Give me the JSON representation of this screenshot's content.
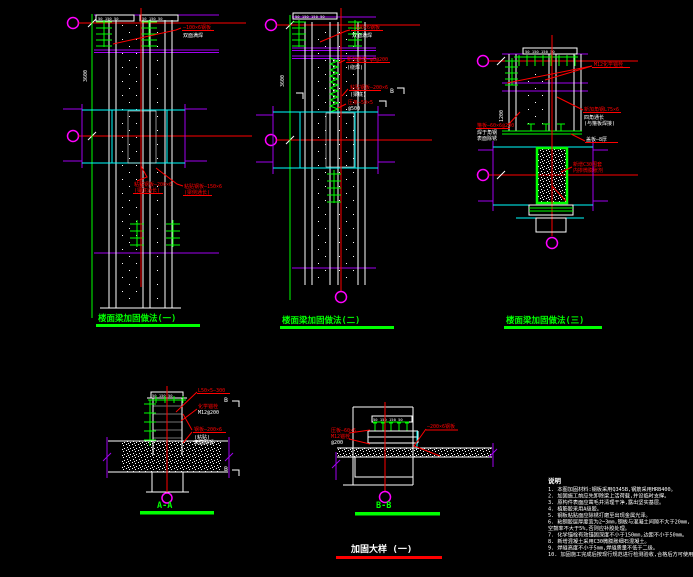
{
  "sheet": {
    "title": "加固大样 (一)"
  },
  "titles": {
    "d1": "楼面梁加固做法(一)",
    "d2": "楼面梁加固做法(二)",
    "d3": "楼面梁加固做法(三)",
    "sectionA": "A-A",
    "sectionB": "B-B"
  },
  "dims": {
    "d1_top": "50 150 50",
    "d2_top": "50 150 150 50",
    "d3_top": "50 150 150 50",
    "a_top": "50 150 50",
    "b_top": "50 150 150 50",
    "d1_h": "3600",
    "d2_h": "3600",
    "d3_h": "1200"
  },
  "callouts": {
    "d1": {
      "top1": "—100×6钢板",
      "top2": "双面满焊",
      "mid_left1": "粘贴钢板—200×6",
      "mid_left2": "(梁底通长)",
      "mid_right1": "粘贴钢板—150×6",
      "mid_right2": "(梁侧通长)"
    },
    "d2": {
      "top1": "—100×6钢板",
      "top2": "双面满焊",
      "coil1": "新加箍筋—φ8@200",
      "coil2": "(绕焊)",
      "mid1": "粘贴钢板—200×6",
      "mid2": "(梁底)",
      "low1": "压条—50×5",
      "low2": "@500",
      "section_letter": "B"
    },
    "d3": {
      "top1": "M12化学锚栓",
      "right1": "新加角钢L75×6",
      "right2": "四角通长",
      "right3": "(与箍板焊接)",
      "left1": "箍板—60×6@200",
      "left2": "焊于角钢",
      "left3": "表面除锈",
      "plate": "盖板—8厚",
      "jacket1": "新增C30围套",
      "jacket2": "内掺微膨胀剂"
    },
    "a": {
      "c1": "L50×5—300",
      "c2a": "化学锚栓",
      "c2b": "M12@200",
      "c3a": "钢板—200×6",
      "c3b": "(粘贴)",
      "c3c": "表面除锈",
      "b_letter": "B"
    },
    "b": {
      "left1": "压板—60×6",
      "left2": "M12锚栓",
      "left3": "@200",
      "right1": "—200×6钢板"
    }
  },
  "notes": {
    "header": "说明",
    "items": [
      "1. 本图加固材料:钢板采用Q345B,钢筋采用HRB400。",
      "2. 加固施工前应先卸除梁上活荷载,并设临时支撑。",
      "3. 原构件表面应凿毛并清理干净,露出坚实基层。",
      "4. 植筋胶采用A级胶。",
      "5. 钢板粘贴面应除锈打磨至出现金属光泽。",
      "6. 粘钢胶层厚度宜为2~3mm,钢板与混凝土间隙不大于20mm,",
      "   空鼓率不大于5%,否则应补胶处理。",
      "7. 化学锚栓有效锚固深度不小于150mm,边距不小于50mm。",
      "8. 新增混凝土采用C30微膨胀细石混凝土。",
      "9. 焊缝高度不小于5mm,焊缝质量不低于二级。",
      "10. 加固施工完成后按现行规范进行检测验收,合格后方可使用。"
    ]
  },
  "colors": {
    "background": "#000000",
    "axis_red": "#ff0000",
    "grid_green": "#00ff00",
    "beam_cyan": "#00ffff",
    "bubble_magenta": "#ff00ff",
    "flange_purple": "#a000f0",
    "line_white": "#ffffff"
  }
}
